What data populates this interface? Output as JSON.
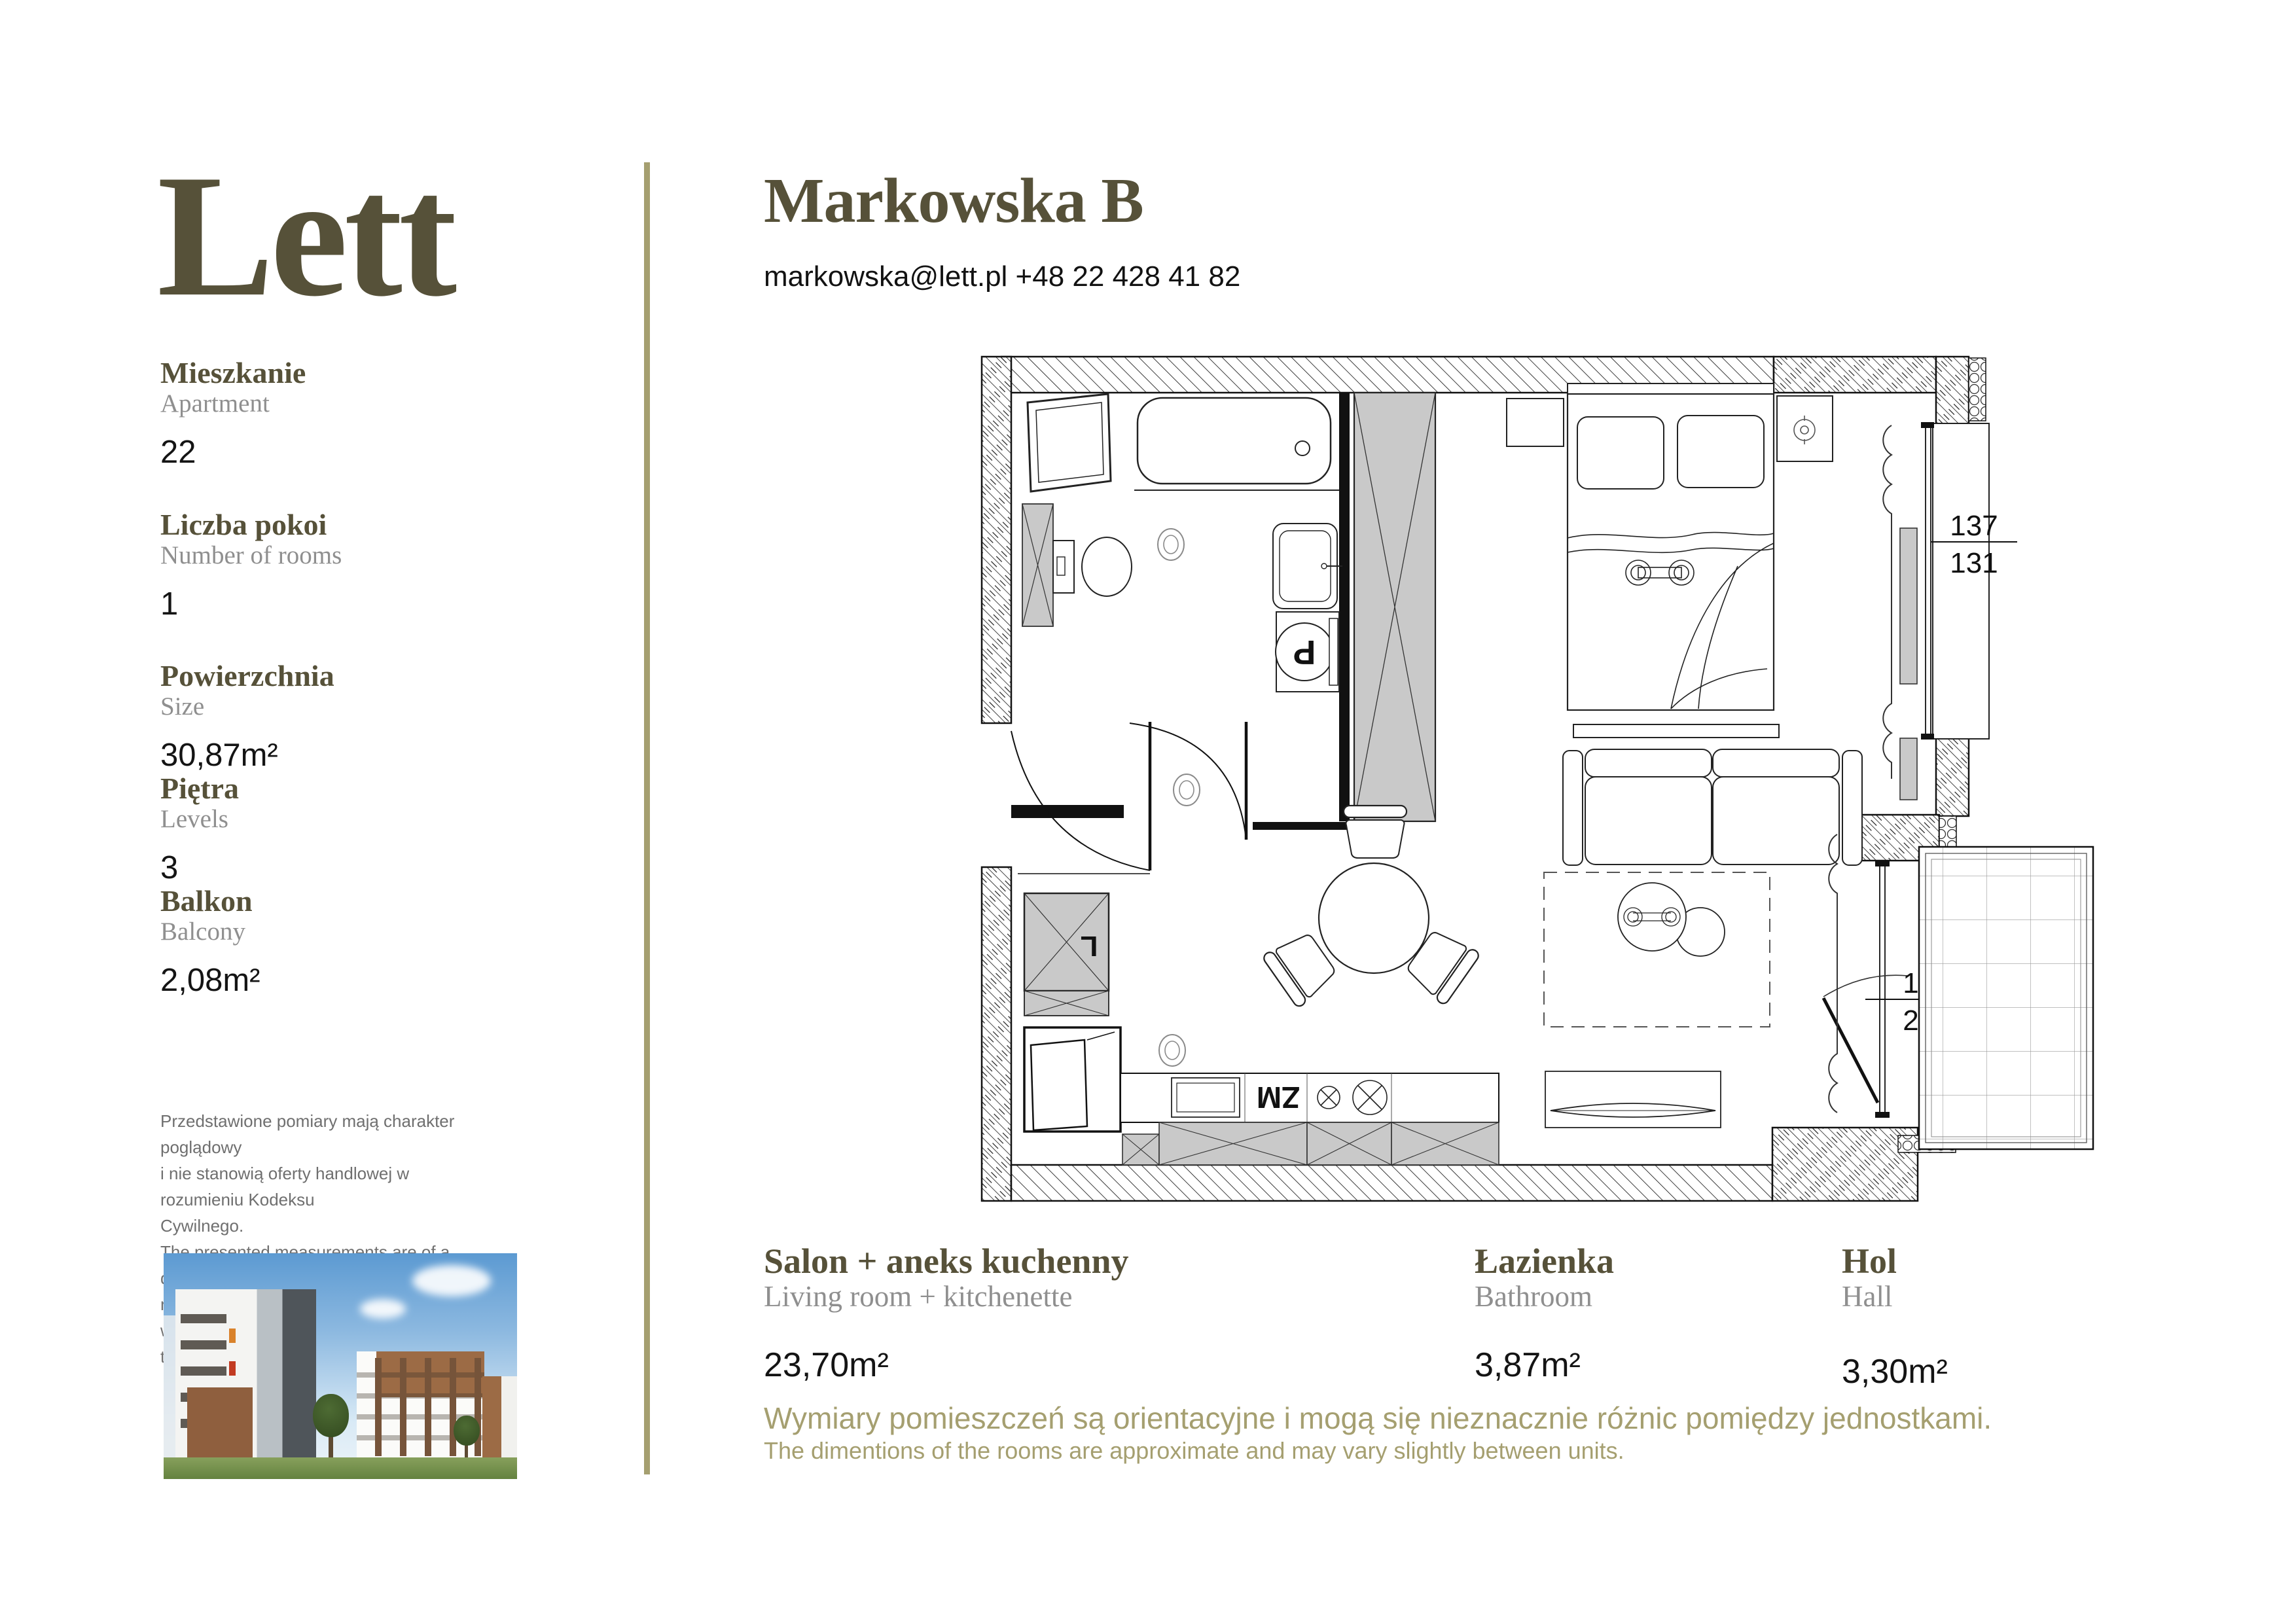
{
  "brand": {
    "logo": "Lett"
  },
  "header": {
    "title": "Markowska B",
    "contact": "markowska@lett.pl +48 22 428 41 82"
  },
  "sidebar": {
    "items": [
      {
        "label_pl": "Mieszkanie",
        "label_en": "Apartment",
        "value": "22"
      },
      {
        "label_pl": "Liczba pokoi",
        "label_en": "Number of rooms",
        "value": "1"
      },
      {
        "label_pl": "Powierzchnia",
        "label_en": "Size",
        "value": "30,87m²"
      },
      {
        "label_pl": "Piętra",
        "label_en": "Levels",
        "value": "3"
      },
      {
        "label_pl": "Balkon",
        "label_en": "Balcony",
        "value": "2,08m²"
      }
    ],
    "disclaimer_lines": [
      "Przedstawione pomiary mają charakter poglądowy",
      "i nie stanowią oferty handlowej w rozumieniu Kodeksu",
      "Cywilnego.",
      "The presented measurements are of a demonstrative",
      "nature and do not constitute a sales offer within",
      "the meaning of the Civil Code."
    ]
  },
  "floorplan": {
    "dim_window": {
      "top": "137",
      "bottom": "131"
    },
    "dim_balcony": {
      "top": "177",
      "bottom": "214"
    },
    "labels": {
      "dishwasher": "ZM",
      "washer": "P",
      "fridge": "L"
    }
  },
  "rooms": [
    {
      "name_pl": "Salon + aneks kuchenny",
      "name_en": "Living room + kitchenette",
      "area": "23,70m²"
    },
    {
      "name_pl": "Łazienka",
      "name_en": "Bathroom",
      "area": "3,87m²"
    },
    {
      "name_pl": "Hol",
      "name_en": "Hall",
      "area": "3,30m²"
    }
  ],
  "footnote": {
    "pl": "Wymiary pomieszczeń są orientacyjne i mogą się nieznacznie różnic pomiędzy jednostkami.",
    "en": "The dimentions of the rooms are approximate and may vary slightly between units."
  },
  "colors": {
    "accent_olive": "#565139",
    "khaki": "#a59f70",
    "muted_gray": "#8f8f8f",
    "furniture_gray": "#c9c9c9"
  }
}
